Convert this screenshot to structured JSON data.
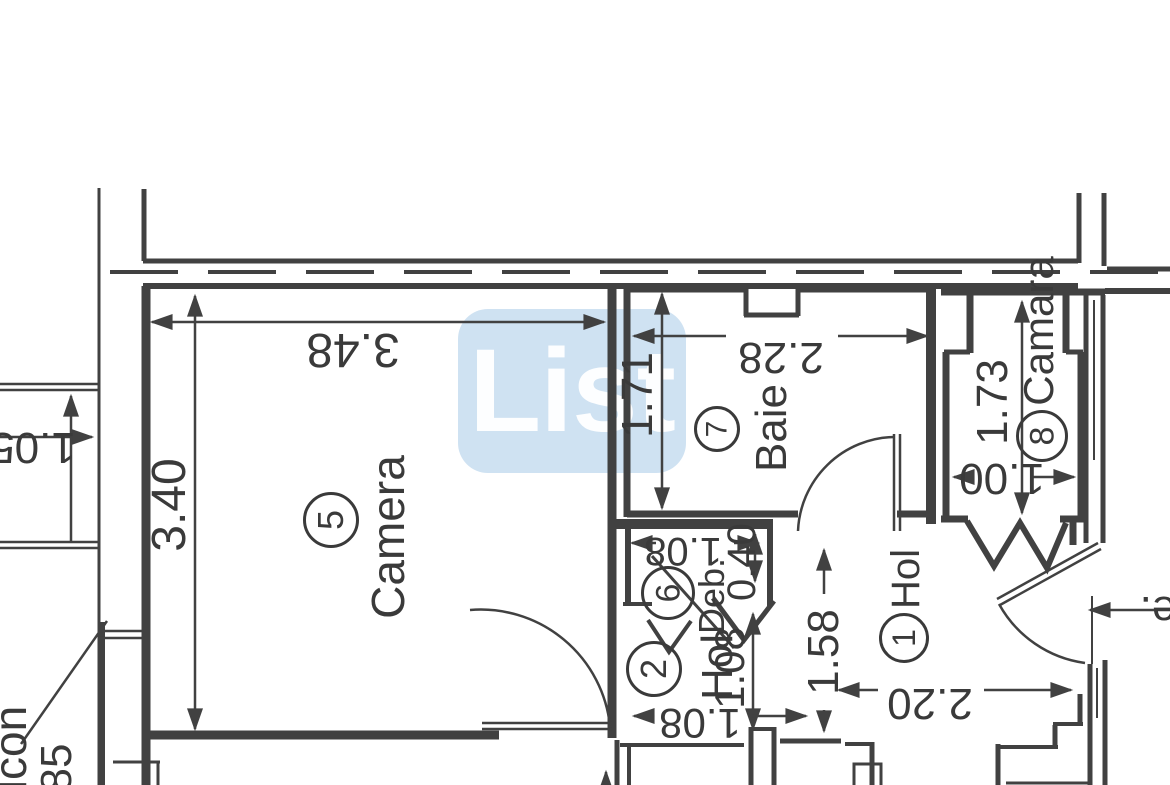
{
  "watermark": {
    "text": "List"
  },
  "rooms": {
    "camera": {
      "number": "5",
      "name": "Camera"
    },
    "baie": {
      "number": "7",
      "name": "Baie"
    },
    "camara": {
      "number": "8",
      "name": "Camara"
    },
    "deb": {
      "number": "6",
      "name": "Deb."
    },
    "hol2": {
      "number": "2",
      "name": "Hol"
    },
    "hol1": {
      "number": "1",
      "name": "Hol"
    }
  },
  "dimensions": {
    "camera_width": "3.48",
    "camera_height": "3.40",
    "baie_width": "2.28",
    "baie_height": "1.71",
    "camara_height": "1.73",
    "camara_width": "1.00",
    "deb_width": "1.08",
    "deb_depth": "0.40",
    "hol2_height": "1.08",
    "hol2_width": "1.08",
    "hol1_height": "1.58",
    "hol1_width": "2.20",
    "left_width": "1.05",
    "bottom_left_number": "85"
  },
  "partial_text": {
    "balcony": "lcon",
    "right_edge": "e."
  },
  "colors": {
    "line": "#414141",
    "text": "#3a3a3a",
    "watermark_bg": "#c5dcef",
    "watermark_text": "#ffffff",
    "background": "#ffffff"
  }
}
